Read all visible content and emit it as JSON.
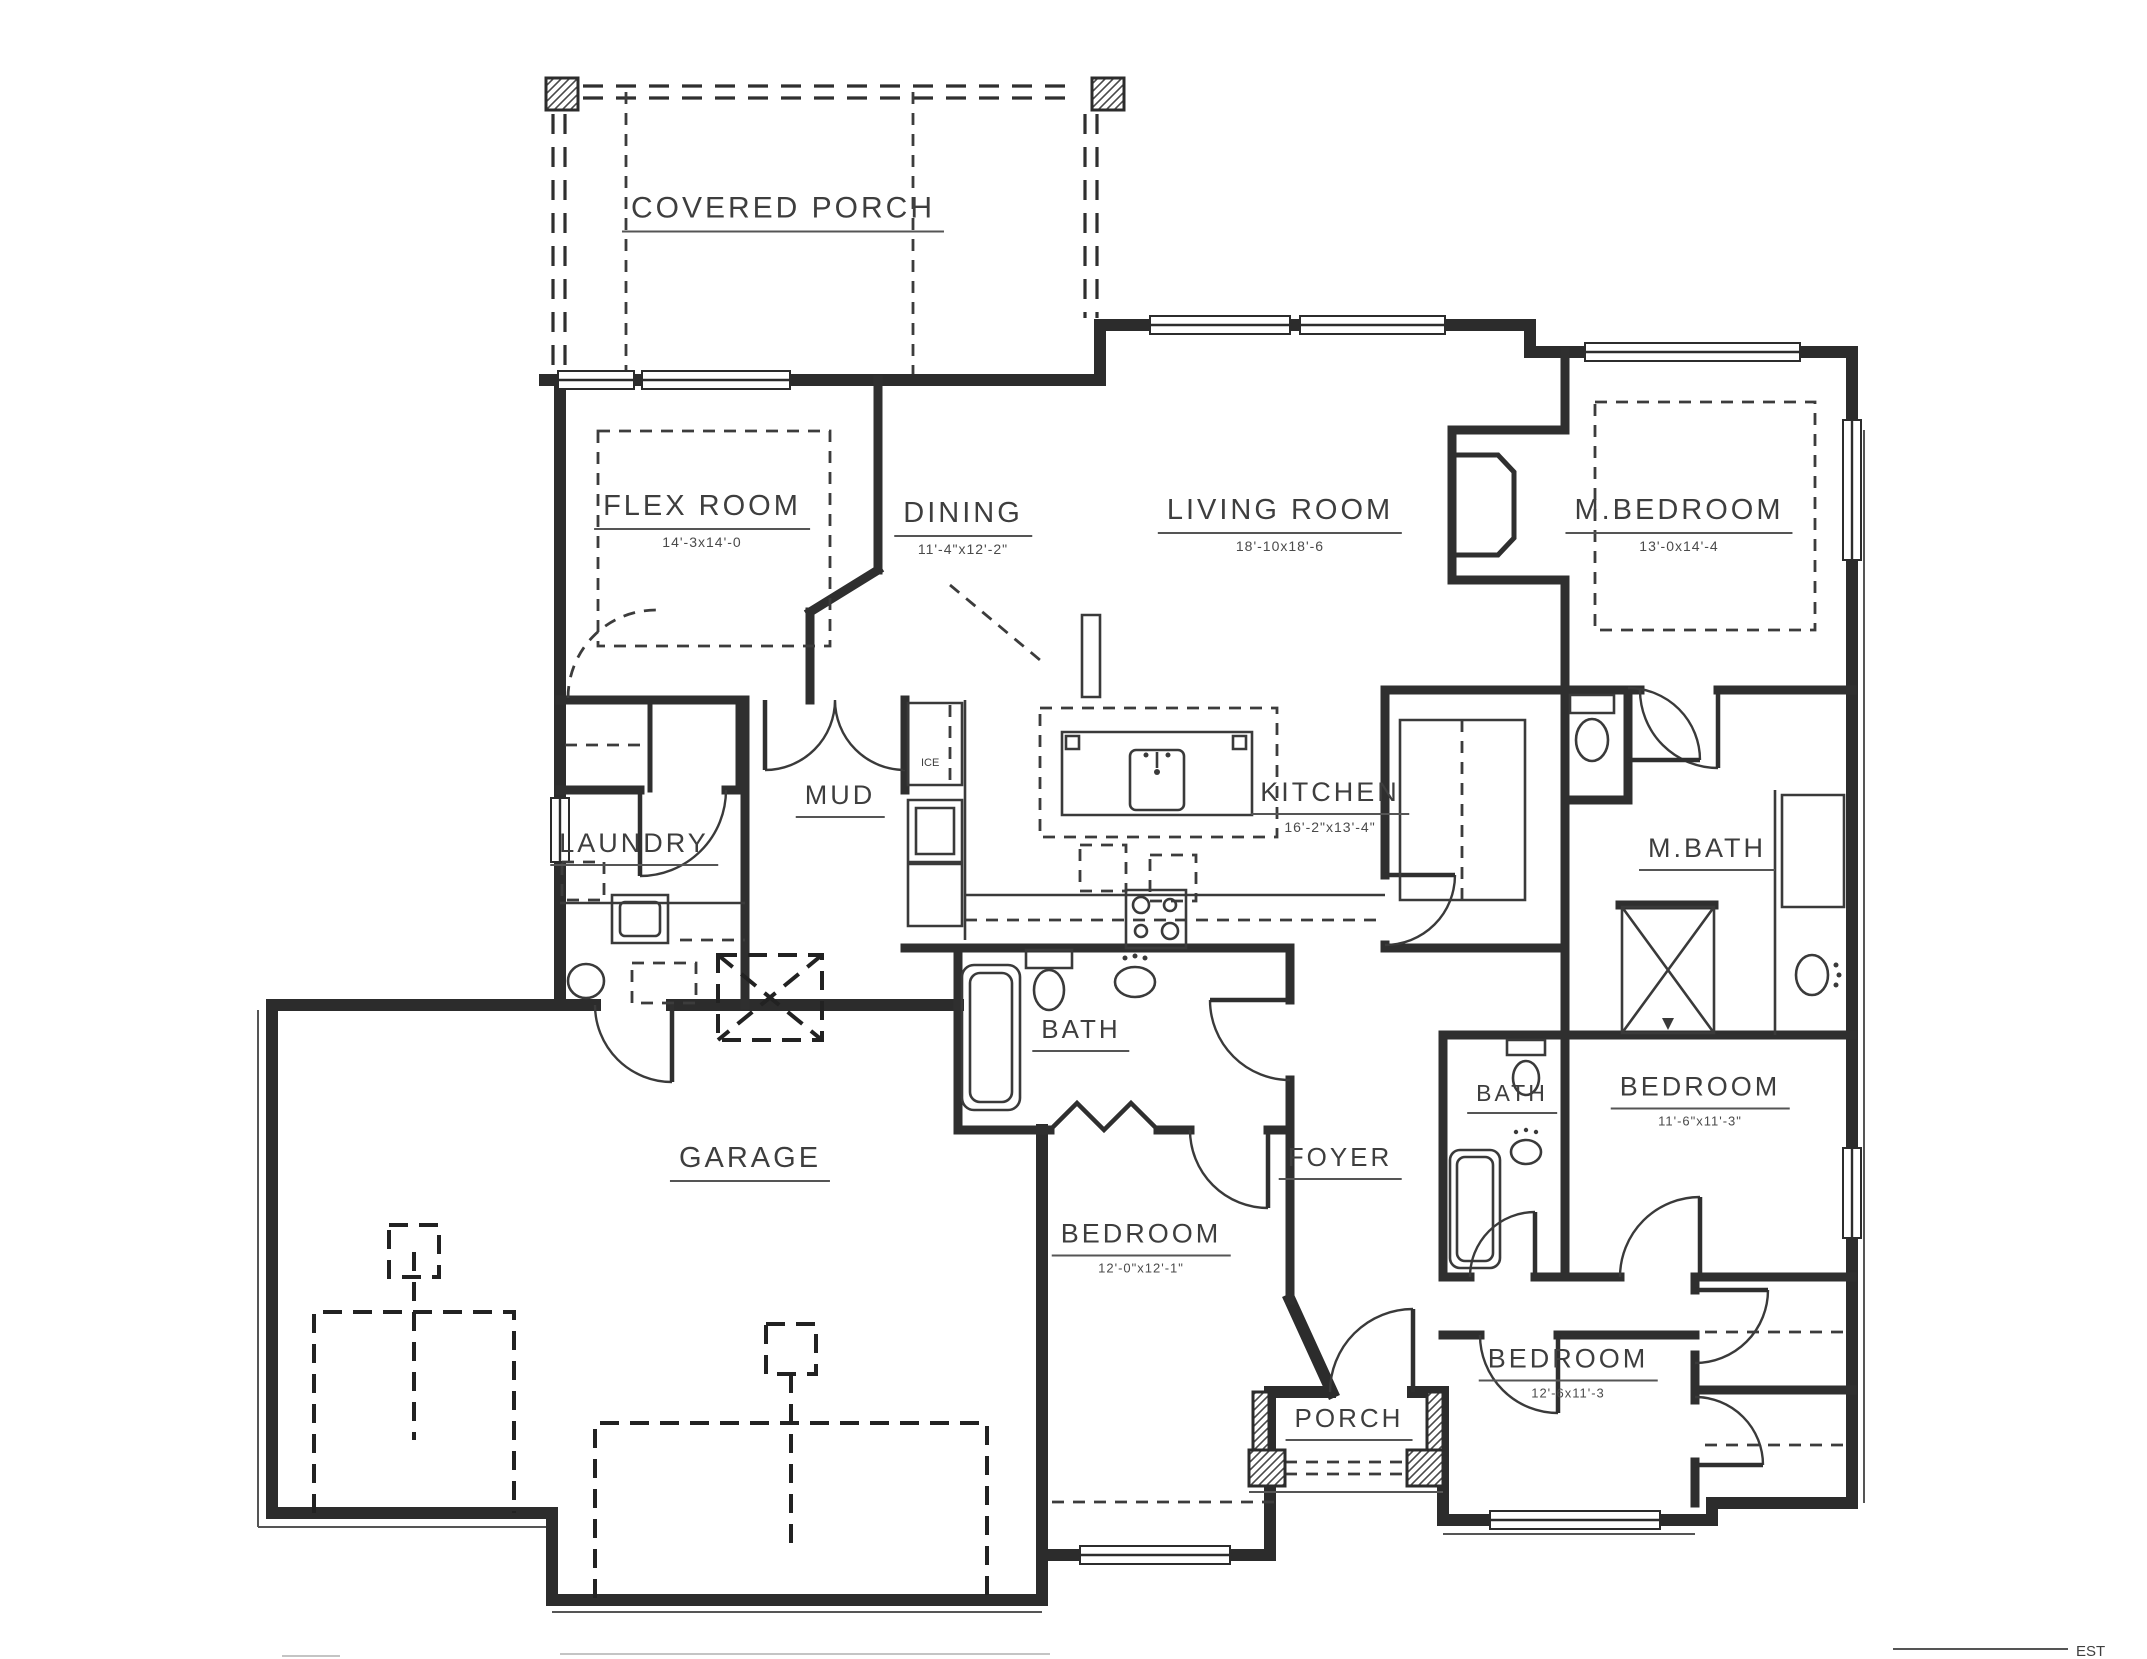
{
  "rooms": {
    "covered_porch": {
      "name": "COVERED PORCH"
    },
    "flex_room": {
      "name": "FLEX ROOM",
      "dims": "14'-3x14'-0"
    },
    "dining": {
      "name": "DINING",
      "dims": "11'-4\"x12'-2\""
    },
    "living_room": {
      "name": "LIVING ROOM",
      "dims": "18'-10x18'-6"
    },
    "m_bedroom": {
      "name": "M.BEDROOM",
      "dims": "13'-0x14'-4"
    },
    "mud": {
      "name": "MUD"
    },
    "kitchen": {
      "name": "KITCHEN",
      "dims": "16'-2\"x13'-4\""
    },
    "laundry": {
      "name": "LAUNDRY"
    },
    "m_bath": {
      "name": "M.BATH"
    },
    "bath_main": {
      "name": "BATH"
    },
    "foyer": {
      "name": "FOYER"
    },
    "bath_hall": {
      "name": "BATH"
    },
    "bedroom_right": {
      "name": "BEDROOM",
      "dims": "11'-6\"x11'-3\""
    },
    "garage": {
      "name": "GARAGE"
    },
    "bedroom_middle": {
      "name": "BEDROOM",
      "dims": "12'-0\"x12'-1\""
    },
    "bedroom_bottom": {
      "name": "BEDROOM",
      "dims": "12'-6x11'-3"
    },
    "porch": {
      "name": "PORCH"
    }
  },
  "labels": {
    "fridge": "ICE",
    "corner_est": "EST"
  },
  "colors": {
    "wall": "#2c2c2c",
    "background": "#ffffff",
    "text": "#3e3e3e"
  }
}
